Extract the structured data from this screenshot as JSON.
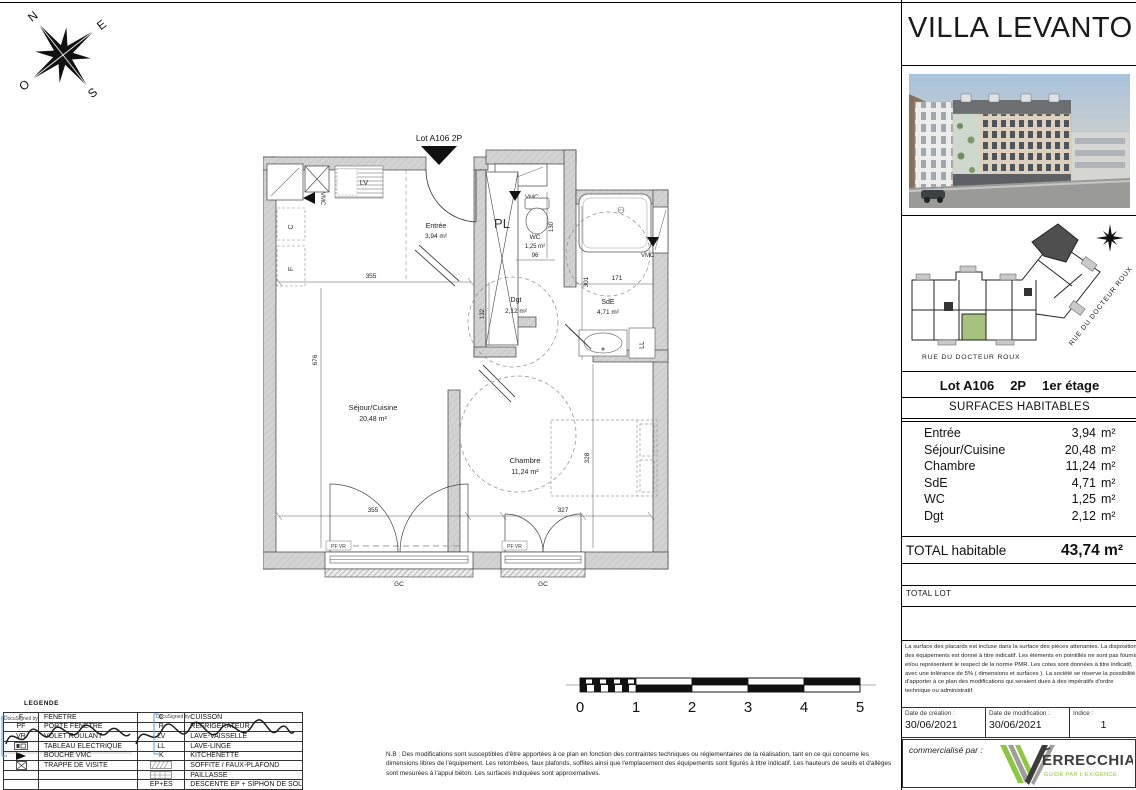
{
  "sheet": {
    "title": "VILLA LEVANTO"
  },
  "compass": {
    "n": "N",
    "e": "E",
    "s": "S",
    "o": "O"
  },
  "plan": {
    "lot_pointer": "Lot A106 2P",
    "rooms": {
      "entree": {
        "name": "Entrée",
        "area": "3,94 m²"
      },
      "sejour": {
        "name": "Séjour/Cuisine",
        "area": "20,48 m²"
      },
      "chambre": {
        "name": "Chambre",
        "area": "11,24 m²"
      },
      "sde": {
        "name": "SdE",
        "area": "4,71 m²"
      },
      "wc": {
        "name": "WC",
        "area": "1,25 m²"
      },
      "dgt": {
        "name": "Dgt",
        "area": "2,12 m²"
      }
    },
    "fixtures": {
      "pl": "PL",
      "lv": "LV",
      "c": "C",
      "f": "F",
      "ll": "LL",
      "vmc": "VMC",
      "pf_vr": "PF VR",
      "gc": "GC"
    },
    "dims": {
      "top_355": "355",
      "wc_96": "96",
      "wc_130": "130",
      "sde_171": "171",
      "sde_301": "301",
      "dgt_132": "132",
      "sejour_676": "676",
      "chambre_328": "328",
      "bottom_355": "355",
      "bottom_327": "327"
    }
  },
  "site_plan": {
    "street_bottom": "RUE DU DOCTEUR ROUX",
    "street_right": "RUE DU DOCTEUR ROUX"
  },
  "lot_info": {
    "lot": "Lot A106",
    "type": "2P",
    "floor": "1er étage"
  },
  "surfaces": {
    "header": "SURFACES HABITABLES",
    "rows": [
      {
        "label": "Entrée",
        "value": "3,94",
        "unit": "m²"
      },
      {
        "label": "Séjour/Cuisine",
        "value": "20,48",
        "unit": "m²"
      },
      {
        "label": "Chambre",
        "value": "11,24",
        "unit": "m²"
      },
      {
        "label": "SdE",
        "value": "4,71",
        "unit": "m²"
      },
      {
        "label": "WC",
        "value": "1,25",
        "unit": "m²"
      },
      {
        "label": "Dgt",
        "value": "2,12",
        "unit": "m²"
      }
    ],
    "total_label": "TOTAL habitable",
    "total_value": "43,74 m²",
    "total_lot_label": "TOTAL LOT"
  },
  "disclaimer": "La surface des placards est incluse dans la surface des pièces attenantes. La disposition des équipements est donné à titre indicatif. Les éléments en pointillés ne sont pas fournis et/ou représentent le respect de la norme PMR. Les cotes sont données à titre indicatif, avec une tolérance de 5% ( dimensions et surfaces ). La société se réserve la possibilité d'apporter à ce plan des modifications qui seraient dues à des impératifs d'ordre technique ou administratif.",
  "dates": {
    "creation_label": "Date de création :",
    "creation": "30/06/2021",
    "modification_label": "Date de modification :",
    "modification": "30/06/2021",
    "indice_label": "Indice :",
    "indice": "1"
  },
  "marketing": {
    "label": "commercialisé par :",
    "logo_text": "ERRECCHIA",
    "tagline": "GUIDÉ PAR L'EXIGENCE",
    "logo_green": "#8dc63f"
  },
  "scalebar": {
    "ticks": [
      "0",
      "1",
      "2",
      "3",
      "4",
      "5"
    ]
  },
  "legend": {
    "title": "LEGENDE",
    "docusign_label": "DocuSigned by:",
    "left": [
      {
        "code": "F",
        "label": "FENÊTRE"
      },
      {
        "code": "PF",
        "label": "PORTE FENÊTRE"
      },
      {
        "code": "VR",
        "label": "VOLET ROULANT"
      },
      {
        "code": "",
        "label": "TABLEAU ÉLECTRIQUE"
      },
      {
        "code": "",
        "label": "BOUCHE VMC"
      },
      {
        "code": "",
        "label": "TRAPPE DE VISITE"
      },
      {
        "code": "",
        "label": ""
      },
      {
        "code": "",
        "label": ""
      }
    ],
    "right": [
      {
        "code": "C",
        "label": "CUISSON"
      },
      {
        "code": "R",
        "label": "RÉFRIGÉRATEUR"
      },
      {
        "code": "LV",
        "label": "LAVE-VAISSELLE"
      },
      {
        "code": "LL",
        "label": "LAVE-LINGE"
      },
      {
        "code": "K",
        "label": "KITCHENETTE"
      },
      {
        "code": "",
        "label": "SOFFITE / FAUX-PLAFOND"
      },
      {
        "code": "",
        "label": "PAILLASSE"
      },
      {
        "code": "EP+ES",
        "label": "DESCENTE EP + SIPHON DE SOL"
      }
    ]
  },
  "nb_note": "N.B : Des modifications sont susceptibles d'être apportées à ce plan en fonction des contraintes techniques ou réglementaires de la réalisation, tant en ce qui concerne les dimensions libres de l'équipement. Les retombées, faux plafonds, soffites ainsi que l'emplacement des équipements sont figurés à titre indicatif. Les hauteurs de seuils et d'allèges sont mesurées à l'appui béton. Les surfaces indiquées sont approximatives.",
  "colors": {
    "wall": "#d3d3d3",
    "unit_green": "#a6c37e"
  }
}
